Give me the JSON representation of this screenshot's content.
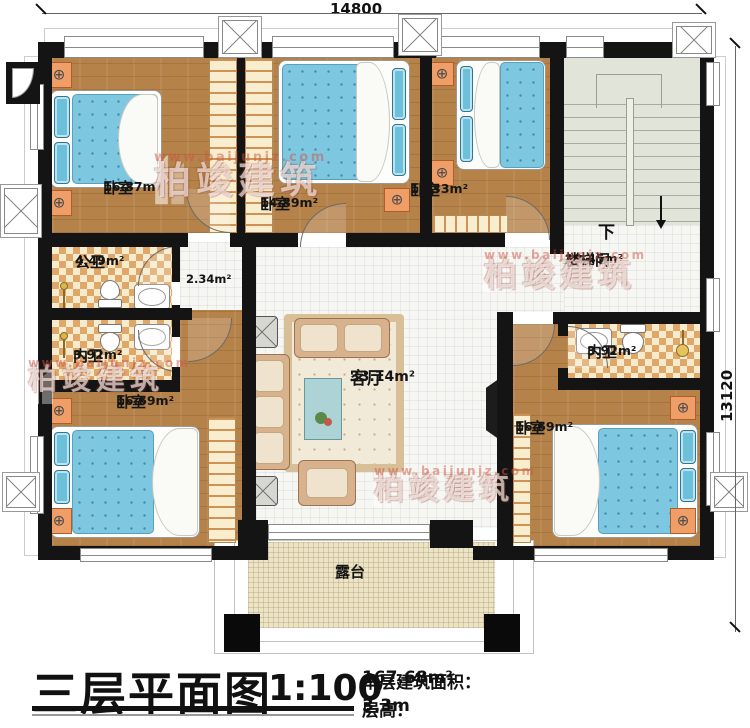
{
  "dimensions": {
    "top": "14800",
    "right": "13120"
  },
  "rooms": {
    "bedroom_tl": {
      "name": "卧室",
      "area": "16.87m²"
    },
    "bedroom_tm": {
      "name": "卧室",
      "area": "14.89m²"
    },
    "bedroom_tr": {
      "name": "卧室",
      "area": "11.33m²"
    },
    "stairwell": {
      "name": "楼梯间",
      "area": "19.45m²"
    },
    "hall": {
      "area": "2.34m²"
    },
    "public_bath": {
      "name": "公卫",
      "area": "4.49m²"
    },
    "inner_bath_left": {
      "name": "内卫",
      "area": "3.92m²"
    },
    "bedroom_bl": {
      "name": "卧室",
      "area": "16.69m²"
    },
    "living_room": {
      "name": "客厅",
      "area": "33.14m²"
    },
    "inner_bath_right": {
      "name": "内卫",
      "area": "3.92m²"
    },
    "bedroom_br": {
      "name": "卧室",
      "area": "16.69m²"
    },
    "terrace": {
      "name": "露台"
    }
  },
  "stairs": {
    "direction": "下"
  },
  "watermark": {
    "brand": "柏竣建筑",
    "url": "www.baijunjz.com"
  },
  "title": {
    "name": "三层平面图",
    "scale": "1:100",
    "area_label": "本层建筑面积：",
    "area_value": "167.68m²",
    "height_label": "层高：",
    "height_value": "3.3m"
  },
  "colors": {
    "wall": "#141414",
    "wood": "#b5824a",
    "white_tile": "#f6f6f3",
    "bath_tile": "#dfa869",
    "stairs": "#e0e4d9",
    "terrace": "#ece4c6",
    "bed_blue": "#7ec7e0"
  }
}
